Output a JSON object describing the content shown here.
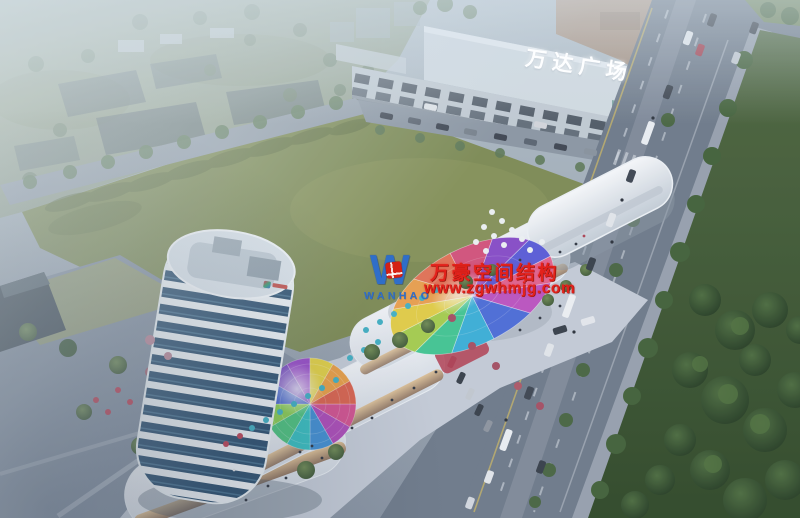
{
  "scene": {
    "description": "dusk aerial rendering of curved retail complex with tower and rainbow canopies beside Wanda Plaza, green field, avenues and park"
  },
  "signs": {
    "wanda_plaza": "万达广场"
  },
  "watermark": {
    "brand": "WANHAO",
    "line1": "万豪空间结构",
    "line2": "www.zgwhmjg.com"
  },
  "palette": {
    "watermark-red": "#e3211b",
    "logo-blue": "#2f6ec9",
    "sign-white": "#fdfeff",
    "field-green": "#7e8b4f",
    "park-green": "#3a5530",
    "road-grey": "#6e7987",
    "building-white": "#eef2f6",
    "tower-glass-blue": "#2c4f6e",
    "haze-white": "#e9f1f3"
  }
}
